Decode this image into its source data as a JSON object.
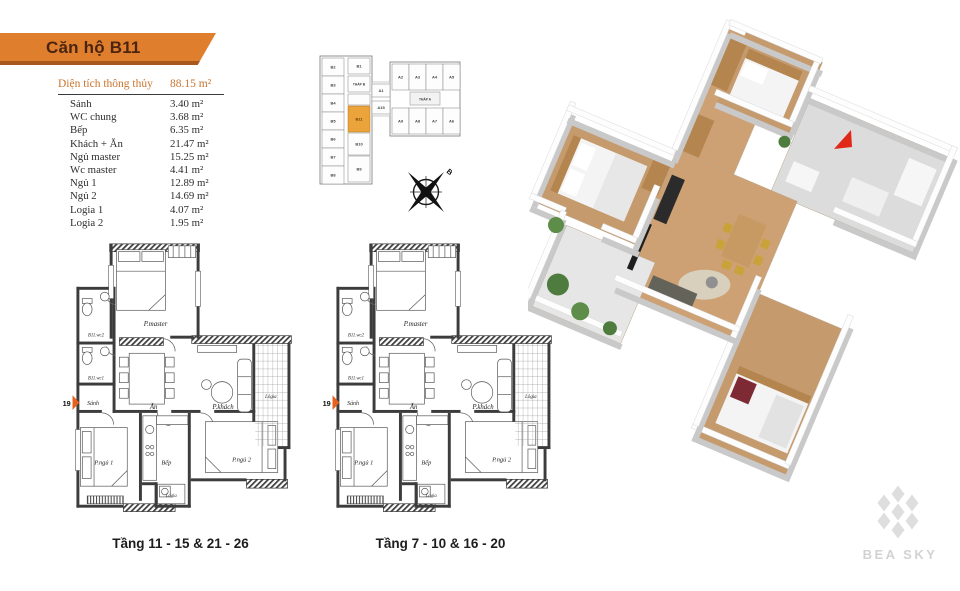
{
  "header": {
    "title": "Căn hộ B11"
  },
  "area_table": {
    "title": "Diện tích thông thủy",
    "total": "88.15 m²",
    "rows": [
      {
        "label": "Sảnh",
        "value": "3.40 m²"
      },
      {
        "label": "WC chung",
        "value": "3.68 m²"
      },
      {
        "label": "Bếp",
        "value": "6.35 m²"
      },
      {
        "label": "Khách + Ăn",
        "value": "21.47 m²"
      },
      {
        "label": "Ngủ master",
        "value": "15.25 m²"
      },
      {
        "label": "Wc master",
        "value": "4.41 m²"
      },
      {
        "label": "Ngủ 1",
        "value": "12.89 m²"
      },
      {
        "label": "Ngủ 2",
        "value": "14.69 m²"
      },
      {
        "label": "Logia 1",
        "value": "4.07 m²"
      },
      {
        "label": "Logia 2",
        "value": "1.95 m²"
      }
    ]
  },
  "key_plan": {
    "tower_b": "THÁP B",
    "tower_a": "THÁP A",
    "b_left": [
      "B2",
      "B3",
      "B4",
      "B5",
      "B6",
      "B7",
      "B8"
    ],
    "b_right": [
      "B1",
      "B11",
      "B10",
      "B9"
    ],
    "connector": [
      "A1",
      "A15"
    ],
    "a_top": [
      "A2",
      "A3",
      "A4",
      "A5"
    ],
    "a_bottom": [
      "A9",
      "A8",
      "A7",
      "A6"
    ],
    "highlight_unit": "B11",
    "compass": "B"
  },
  "plan_rooms": {
    "master": "P.master",
    "wc2": "B11.wc2",
    "wc1": "B11.wc1",
    "hall": "Sảnh",
    "dining": "Ăn",
    "living": "P.khách",
    "logia": "Lôgia",
    "bed1": "P.ngủ 1",
    "kitchen": "Bếp",
    "bed2": "P.ngủ 2",
    "logia2": "Lógia",
    "axis": "19"
  },
  "floor_plans": [
    {
      "caption": "Tầng 11 - 15 & 21 - 26"
    },
    {
      "caption": "Tầng 7 - 10 & 16 - 20"
    }
  ],
  "logo": {
    "text": "BEA SKY"
  },
  "colors": {
    "banner": "#DF7F2E",
    "accent": "#C9742E",
    "highlight": "#EBA33B",
    "marker_red": "#E02718",
    "logo_gray": "#dedede"
  }
}
